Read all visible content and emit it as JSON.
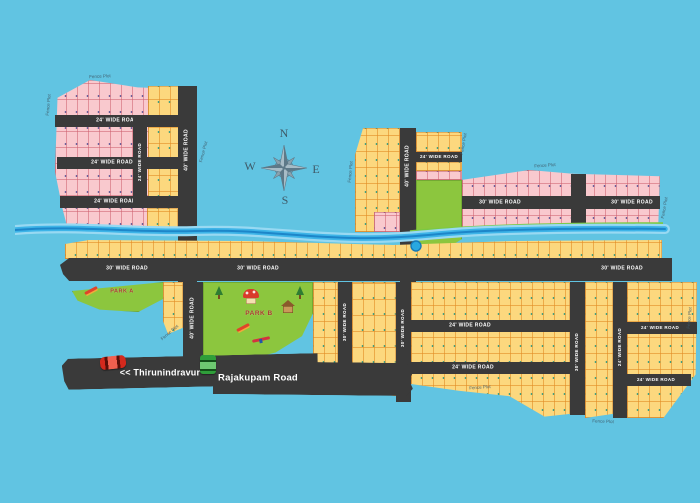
{
  "compass": {
    "north": "N",
    "east": "E",
    "south": "S",
    "west": "W"
  },
  "road_labels": {
    "wide40": "40' WIDE ROAD",
    "wide30": "30' WIDE ROAD",
    "wide24": "24' WIDE ROAD"
  },
  "boundary": {
    "fence_plot": "Fence Plot"
  },
  "parks": {
    "park_a": "PARK A",
    "park_b": "PARK B"
  },
  "signs": {
    "thirunindravur": "<< Thirunindravur",
    "rajakupam": "Rajakupam Road"
  },
  "icons": [
    "compass-rose",
    "red-car",
    "green-truck",
    "tree",
    "playhouse",
    "hut",
    "slide",
    "seesaw",
    "pond",
    "stream"
  ],
  "colors": {
    "sky": "#61c4e2",
    "plot_pink": "#f9c9ce",
    "plot_yellow": "#fcd87e",
    "road": "#3a3a3a",
    "park_green": "#8cc63e",
    "stream": "#29abe2",
    "stream_line": "#1d86c9",
    "sign_text": "#ffffff"
  }
}
